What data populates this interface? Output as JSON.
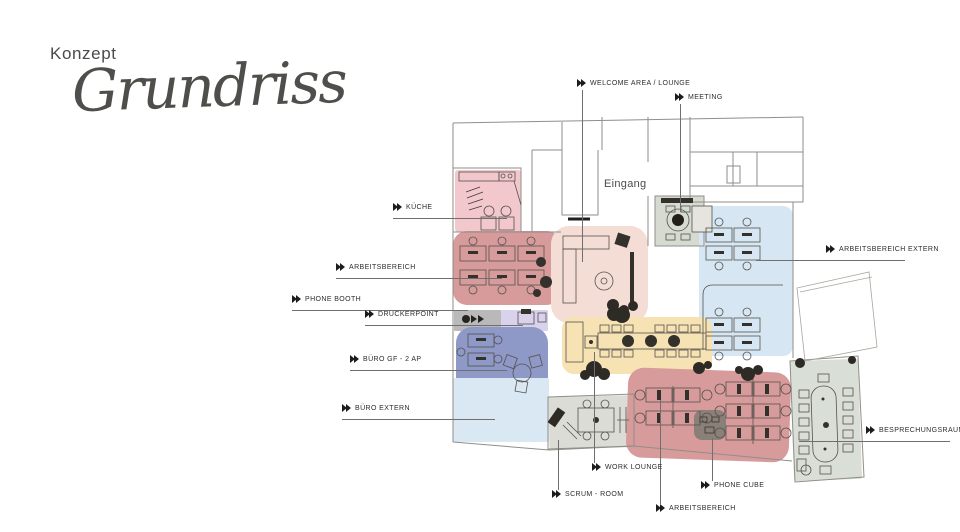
{
  "title": {
    "kicker": "Konzept",
    "name": "Grundriss"
  },
  "plan": {
    "entrance_label": "Eingang",
    "entrance_pos": {
      "x": 604,
      "y": 178
    },
    "colors": {
      "label_text": "#2d2d2d",
      "leader_line": "#6f6f6f",
      "wall_line": "#918e88",
      "accent_dark": "#34312c"
    },
    "regions": [
      {
        "id": "kueche",
        "color": "#f2c8cc",
        "x": 455,
        "y": 170,
        "w": 66,
        "h": 62,
        "r": 3,
        "rot": 0
      },
      {
        "id": "arbeitsbereich-1",
        "color": "#d89b9b",
        "x": 453,
        "y": 231,
        "w": 108,
        "h": 74,
        "r": 14,
        "rot": 0
      },
      {
        "id": "welcome-lounge",
        "color": "#f4ddd5",
        "x": 551,
        "y": 226,
        "w": 97,
        "h": 97,
        "r": 18,
        "rot": 0
      },
      {
        "id": "meeting",
        "color": "#d6dbd2",
        "x": 655,
        "y": 196,
        "w": 49,
        "h": 50,
        "r": 2,
        "rot": 0
      },
      {
        "id": "arbeitsbereich-extern",
        "color": "#d6e7f3",
        "x": 699,
        "y": 206,
        "w": 94,
        "h": 150,
        "r": 10,
        "rot": 0
      },
      {
        "id": "phone-booth",
        "color": "#b9b9ba",
        "x": 454,
        "y": 310,
        "w": 47,
        "h": 21,
        "r": 1,
        "rot": 0
      },
      {
        "id": "druckerpoint",
        "color": "#d9d2ec",
        "x": 501,
        "y": 310,
        "w": 47,
        "h": 21,
        "r": 1,
        "rot": 0
      },
      {
        "id": "buero-gf",
        "color": "#8e99c8",
        "x": 456,
        "y": 327,
        "w": 92,
        "h": 66,
        "r": 16,
        "rot": 0
      },
      {
        "id": "buero-extern",
        "color": "#dae8f4",
        "x": 453,
        "y": 378,
        "w": 96,
        "h": 64,
        "r": 2,
        "rot": 0
      },
      {
        "id": "work-lounge",
        "color": "#f6e2b3",
        "x": 562,
        "y": 317,
        "w": 150,
        "h": 57,
        "r": 12,
        "rot": 0
      },
      {
        "id": "scrum-room",
        "color": "#dcdcd7",
        "x": 549,
        "y": 396,
        "w": 85,
        "h": 52,
        "r": 2,
        "rot": -1
      },
      {
        "id": "arbeitsbereich-2",
        "color": "#d89b9b",
        "x": 627,
        "y": 370,
        "w": 163,
        "h": 90,
        "r": 16,
        "rot": 2
      },
      {
        "id": "phone-cube",
        "color": "#8a8078",
        "x": 694,
        "y": 410,
        "w": 32,
        "h": 30,
        "r": 8,
        "rot": 0
      },
      {
        "id": "besprechungsraum",
        "color": "#d9ded6",
        "x": 792,
        "y": 360,
        "w": 68,
        "h": 120,
        "r": 2,
        "rot": -2
      }
    ],
    "labels": [
      {
        "id": "welcome-area",
        "text": "WELCOME AREA / LOUNGE",
        "x": 577,
        "y": 79,
        "leader": {
          "dir": "v",
          "x": 582,
          "y": 90,
          "len": 172
        }
      },
      {
        "id": "meeting",
        "text": "MEETING",
        "x": 675,
        "y": 93,
        "leader": {
          "dir": "v",
          "x": 680,
          "y": 104,
          "len": 108
        }
      },
      {
        "id": "kueche",
        "text": "KÜCHE",
        "x": 393,
        "y": 203,
        "leader": {
          "dir": "h",
          "x": 393,
          "y": 218,
          "len": 114
        }
      },
      {
        "id": "arbeitsbereich-1",
        "text": "ARBEITSBEREICH",
        "x": 336,
        "y": 263,
        "leader": {
          "dir": "h",
          "x": 336,
          "y": 278,
          "len": 166
        }
      },
      {
        "id": "phone-booth",
        "text": "PHONE BOOTH",
        "x": 292,
        "y": 295,
        "leader": {
          "dir": "h",
          "x": 292,
          "y": 310,
          "len": 176
        }
      },
      {
        "id": "druckerpoint",
        "text": "DRUCKERPOINT",
        "x": 365,
        "y": 310,
        "leader": {
          "dir": "h",
          "x": 365,
          "y": 325,
          "len": 158
        }
      },
      {
        "id": "buero-gf",
        "text": "BÜRO GF - 2 AP",
        "x": 350,
        "y": 355,
        "leader": {
          "dir": "h",
          "x": 350,
          "y": 370,
          "len": 157
        }
      },
      {
        "id": "buero-extern",
        "text": "BÜRO EXTERN",
        "x": 342,
        "y": 404,
        "leader": {
          "dir": "h",
          "x": 342,
          "y": 419,
          "len": 153
        }
      },
      {
        "id": "arbeitsbereich-extern",
        "text": "ARBEITSBEREICH EXTERN",
        "x": 826,
        "y": 245,
        "leader": {
          "dir": "h",
          "x": 756,
          "y": 260,
          "len": 149
        }
      },
      {
        "id": "besprechungsraum",
        "text": "BESPRECHUNGSRAUM",
        "x": 866,
        "y": 426,
        "leader": {
          "dir": "h",
          "x": 799,
          "y": 441,
          "len": 151
        }
      },
      {
        "id": "work-lounge",
        "text": "WORK LOUNGE",
        "x": 592,
        "y": 463,
        "leader": {
          "dir": "v",
          "x": 594,
          "y": 352,
          "len": 111
        }
      },
      {
        "id": "scrum-room",
        "text": "SCRUM - ROOM",
        "x": 552,
        "y": 490,
        "leader": {
          "dir": "v",
          "x": 558,
          "y": 440,
          "len": 50
        }
      },
      {
        "id": "phone-cube",
        "text": "PHONE CUBE",
        "x": 701,
        "y": 481,
        "leader": {
          "dir": "v",
          "x": 712,
          "y": 438,
          "len": 43
        }
      },
      {
        "id": "arbeitsbereich-2",
        "text": "ARBEITSBEREICH",
        "x": 656,
        "y": 504,
        "leader": {
          "dir": "v",
          "x": 660,
          "y": 400,
          "len": 104
        }
      }
    ]
  }
}
